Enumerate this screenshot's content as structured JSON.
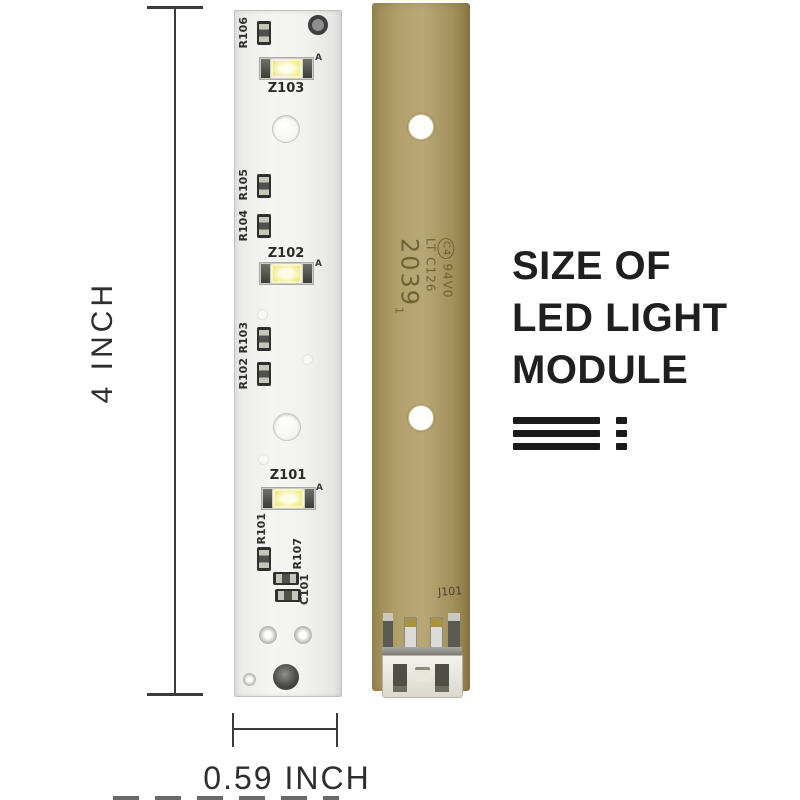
{
  "front_pcb": {
    "labels": {
      "r106": "R106",
      "r105": "R105",
      "r104": "R104",
      "r103": "R103",
      "r102": "R102",
      "r101": "R101",
      "r107": "R107",
      "c101": "C101"
    },
    "leds": [
      {
        "label": "Z103",
        "anode": "A"
      },
      {
        "label": "Z102",
        "anode": "A"
      },
      {
        "label": "Z101",
        "anode": "A"
      }
    ]
  },
  "back_pcb": {
    "stamp": {
      "cert_mark": "C4",
      "flammability": "94V0",
      "code": "LT C126",
      "date_code": "2039",
      "date_sub": "1"
    },
    "connector_ref": "J101"
  },
  "dimensions": {
    "height": "4 INCH",
    "width": "0.59 INCH"
  },
  "caption": {
    "line1": "SIZE OF",
    "line2": "LED LIGHT",
    "line3": "MODULE"
  },
  "colors": {
    "front_pcb": "#f2f2f0",
    "back_pcb": "#b1a06a",
    "led_yellow": "#f0e985",
    "silkscreen": "#2e2e2c",
    "stamp_ink": "#6d5c32",
    "caption_text": "#1f1f1f",
    "dimension_lines": "#3b3b3b"
  }
}
